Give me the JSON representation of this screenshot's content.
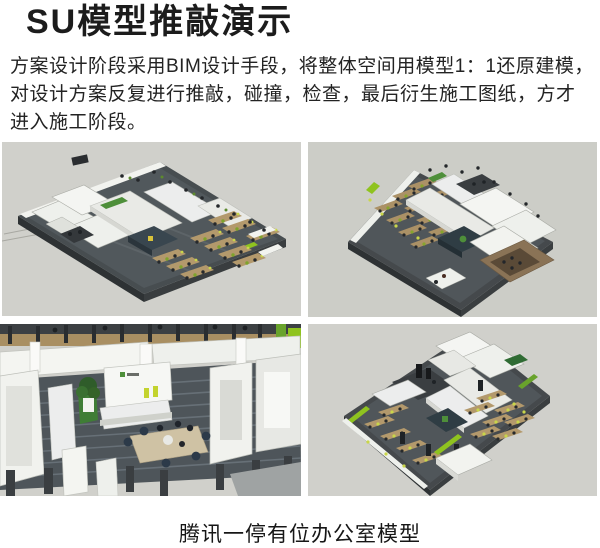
{
  "title": "SU模型推敲演示",
  "paragraph": {
    "lines": [
      "方案设计阶段采用BIM设计手段，将整体空间用模型1：1还原建模，",
      "对设计方案反复进行推敲，碰撞，检查，最后衍生施工图纸，方才",
      "进入施工阶段。"
    ]
  },
  "gallery": {
    "images": [
      {
        "name": "isometric-office-model-overview-left"
      },
      {
        "name": "isometric-office-model-overview-right"
      },
      {
        "name": "office-model-interior-reception-view"
      },
      {
        "name": "isometric-office-model-overview-rotated"
      }
    ]
  },
  "caption": "腾讯一停有位办公室模型",
  "colors": {
    "page_background": "#ffffff",
    "image_background": "#d0d0cb",
    "floor_dark": "#474d50",
    "wall_white": "#f2f3ef",
    "wood": "#b3996c",
    "accent_green": "#8fc31f",
    "plant_green": "#3f7d35",
    "navy": "#2c3a49",
    "text": "#1f1f1f"
  }
}
